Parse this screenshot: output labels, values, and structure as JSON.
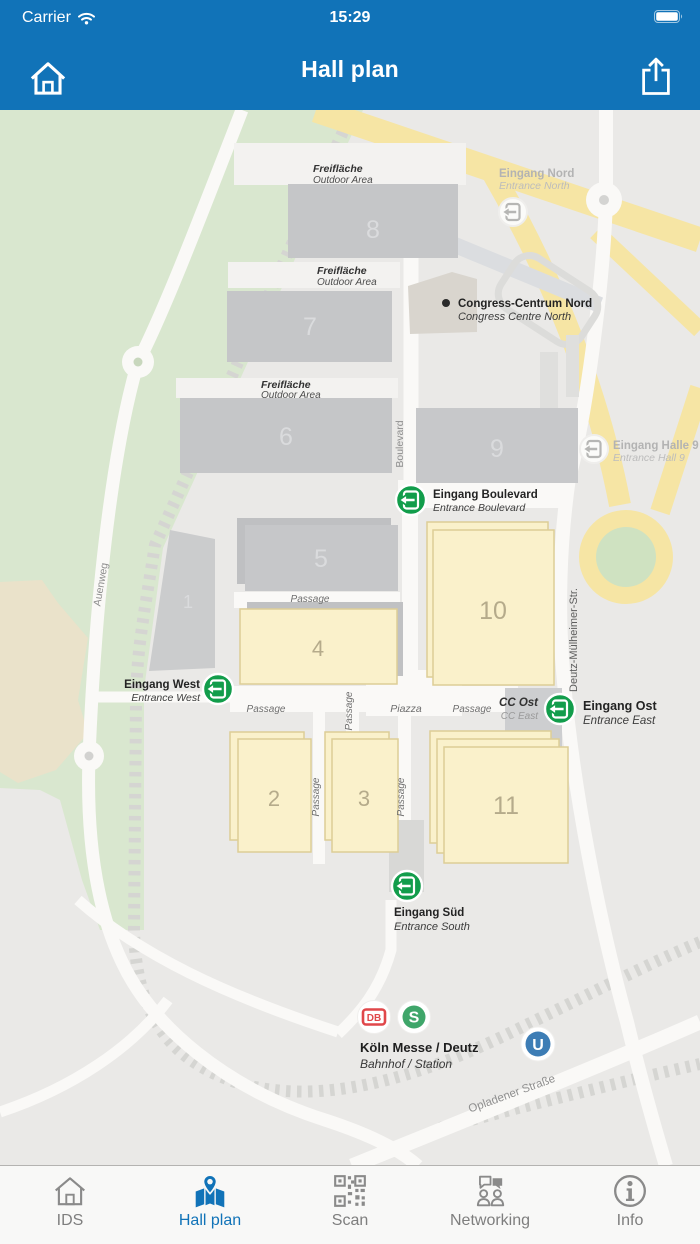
{
  "status_bar": {
    "carrier": "Carrier",
    "time": "15:29"
  },
  "nav_bar": {
    "title": "Hall plan",
    "left_icon": "home-icon",
    "right_icon": "share-icon"
  },
  "map": {
    "streets": {
      "auenweg": "Auenweg",
      "boulevard": "Boulevard",
      "deutz_muelheimer": "Deutz-Mülheimer-Str.",
      "opladener": "Opladener Straße"
    },
    "areas": {
      "freiflaeche_de": "Freifläche",
      "freiflaeche_en": "Outdoor Area",
      "passage": "Passage",
      "piazza": "Piazza",
      "cc_ost_de": "CC Ost",
      "cc_ost_en": "CC East"
    },
    "pois": {
      "congress_de": "Congress-Centrum Nord",
      "congress_en": "Congress Centre North",
      "station_de": "Köln Messe / Deutz",
      "station_en": "Bahnhof / Station"
    },
    "entrances": {
      "nord_de": "Eingang Nord",
      "nord_en": "Entrance North",
      "halle9_de": "Eingang Halle 9",
      "halle9_en": "Entrance Hall 9",
      "boulevard_de": "Eingang Boulevard",
      "boulevard_en": "Entrance Boulevard",
      "west_de": "Eingang West",
      "west_en": "Entrance West",
      "ost_de": "Eingang Ost",
      "ost_en": "Entrance East",
      "sued_de": "Eingang Süd",
      "sued_en": "Entrance South"
    },
    "hall_numbers": {
      "h1": "1",
      "h2": "2",
      "h3": "3",
      "h4": "4",
      "h5": "5",
      "h6": "6",
      "h7": "7",
      "h8": "8",
      "h9": "9",
      "h10": "10",
      "h11": "11"
    },
    "transit": {
      "db": "DB",
      "sbahn": "S",
      "ubahn": "U"
    },
    "colors": {
      "park_green": "#D9E7CF",
      "road_yellow": "#F6E5A4",
      "hall_gray": "#C5C6C8",
      "hall_yellow": "#FAF1CB",
      "hall_yellow_border": "#DDCE96",
      "entrance_green": "#129D4B",
      "db_red": "#E0474A",
      "sbahn_green": "#3FA66A",
      "ubahn_blue": "#3D7DB5"
    }
  },
  "tab_bar": {
    "active_color": "#1173B8",
    "inactive_color": "#8A8A8A",
    "items": [
      {
        "label": "IDS",
        "icon": "home-icon",
        "active": false
      },
      {
        "label": "Hall plan",
        "icon": "map-pin-icon",
        "active": true
      },
      {
        "label": "Scan",
        "icon": "qr-code-icon",
        "active": false
      },
      {
        "label": "Networking",
        "icon": "chat-people-icon",
        "active": false
      },
      {
        "label": "Info",
        "icon": "info-icon",
        "active": false
      }
    ]
  },
  "ui_colors": {
    "header_blue": "#1173B8"
  }
}
